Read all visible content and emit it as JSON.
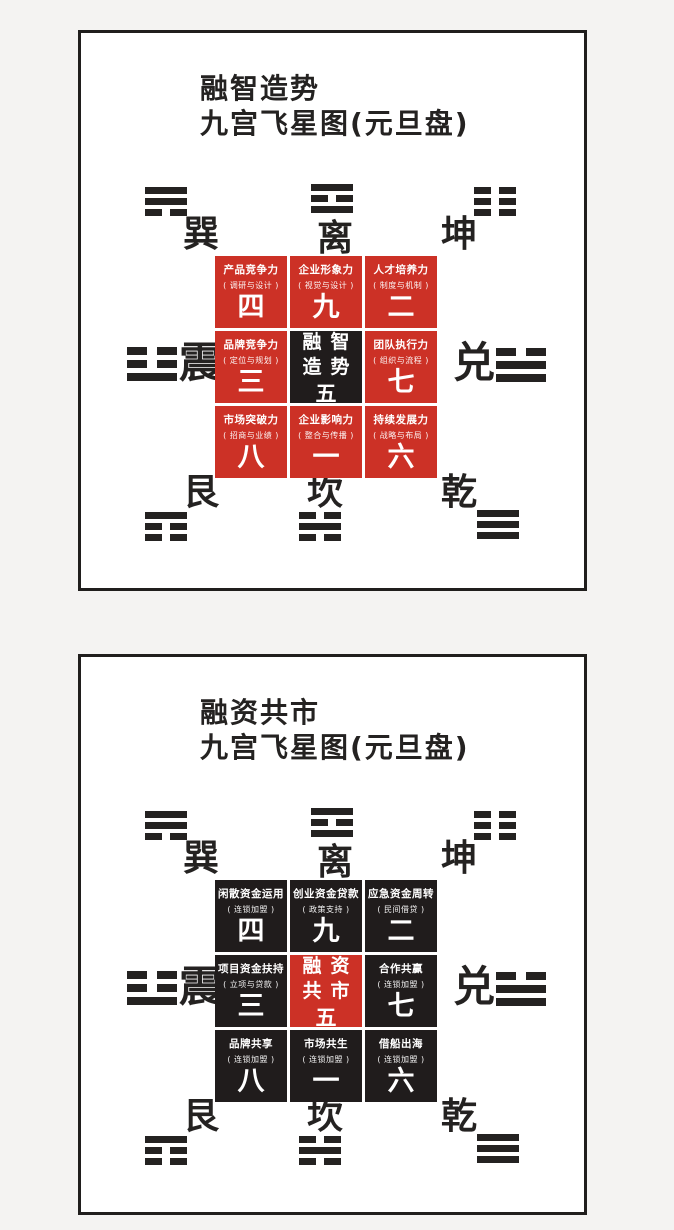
{
  "colors": {
    "page_background": "#f4f3f2",
    "panel_background": "#ffffff",
    "panel_border": "#201e1d",
    "cell_red": "#cc3126",
    "cell_black": "#201c1c",
    "cell_text": "#ffffff",
    "ink": "#242221"
  },
  "compass_labels": {
    "xun": "巽",
    "li": "离",
    "kun": "坤",
    "zhen": "震",
    "dui": "兑",
    "gen": "艮",
    "kan": "坎",
    "qian": "乾"
  },
  "trigrams": {
    "xun": [
      "solid",
      "solid",
      "broken"
    ],
    "li": [
      "solid",
      "broken",
      "solid"
    ],
    "kun": [
      "broken",
      "broken",
      "broken"
    ],
    "zhen": [
      "broken",
      "broken",
      "solid"
    ],
    "dui": [
      "broken",
      "solid",
      "solid"
    ],
    "gen": [
      "solid",
      "broken",
      "broken"
    ],
    "kan": [
      "broken",
      "solid",
      "broken"
    ],
    "qian": [
      "solid",
      "solid",
      "solid"
    ]
  },
  "panels": [
    {
      "title_line1": "融智造势",
      "title_line2": "九宫飞星图(元旦盘)",
      "cells": [
        {
          "name": "产品竞争力",
          "sub": "( 调研与设计 )",
          "star": "四",
          "variant": "red"
        },
        {
          "name": "企业形象力",
          "sub": "( 视觉与设计 )",
          "star": "九",
          "variant": "red"
        },
        {
          "name": "人才培养力",
          "sub": "( 制度与机制 )",
          "star": "二",
          "variant": "red"
        },
        {
          "name": "品牌竞争力",
          "sub": "( 定位与规划 )",
          "star": "三",
          "variant": "red"
        },
        {
          "name": "融智\n造势",
          "sub": "",
          "star": "五",
          "variant": "black center"
        },
        {
          "name": "团队执行力",
          "sub": "( 组织与流程 )",
          "star": "七",
          "variant": "red"
        },
        {
          "name": "市场突破力",
          "sub": "( 招商与业绩 )",
          "star": "八",
          "variant": "red"
        },
        {
          "name": "企业影响力",
          "sub": "( 整合与传播 )",
          "star": "一",
          "variant": "red"
        },
        {
          "name": "持续发展力",
          "sub": "( 战略与布局 )",
          "star": "六",
          "variant": "red"
        }
      ]
    },
    {
      "title_line1": "融资共市",
      "title_line2": "九宫飞星图(元旦盘)",
      "cells": [
        {
          "name": "闲散资金运用",
          "sub": "( 连锁加盟 )",
          "star": "四",
          "variant": "black"
        },
        {
          "name": "创业资金贷款",
          "sub": "( 政策支持 )",
          "star": "九",
          "variant": "black"
        },
        {
          "name": "应急资金周转",
          "sub": "( 民间借贷 )",
          "star": "二",
          "variant": "black"
        },
        {
          "name": "项目资金扶持",
          "sub": "( 立项与贷款 )",
          "star": "三",
          "variant": "black"
        },
        {
          "name": "融资\n共市",
          "sub": "",
          "star": "五",
          "variant": "red center"
        },
        {
          "name": "合作共赢",
          "sub": "( 连锁加盟 )",
          "star": "七",
          "variant": "black"
        },
        {
          "name": "品牌共享",
          "sub": "( 连锁加盟 )",
          "star": "八",
          "variant": "black"
        },
        {
          "name": "市场共生",
          "sub": "( 连锁加盟 )",
          "star": "一",
          "variant": "black"
        },
        {
          "name": "借船出海",
          "sub": "( 连锁加盟 )",
          "star": "六",
          "variant": "black"
        }
      ]
    }
  ]
}
